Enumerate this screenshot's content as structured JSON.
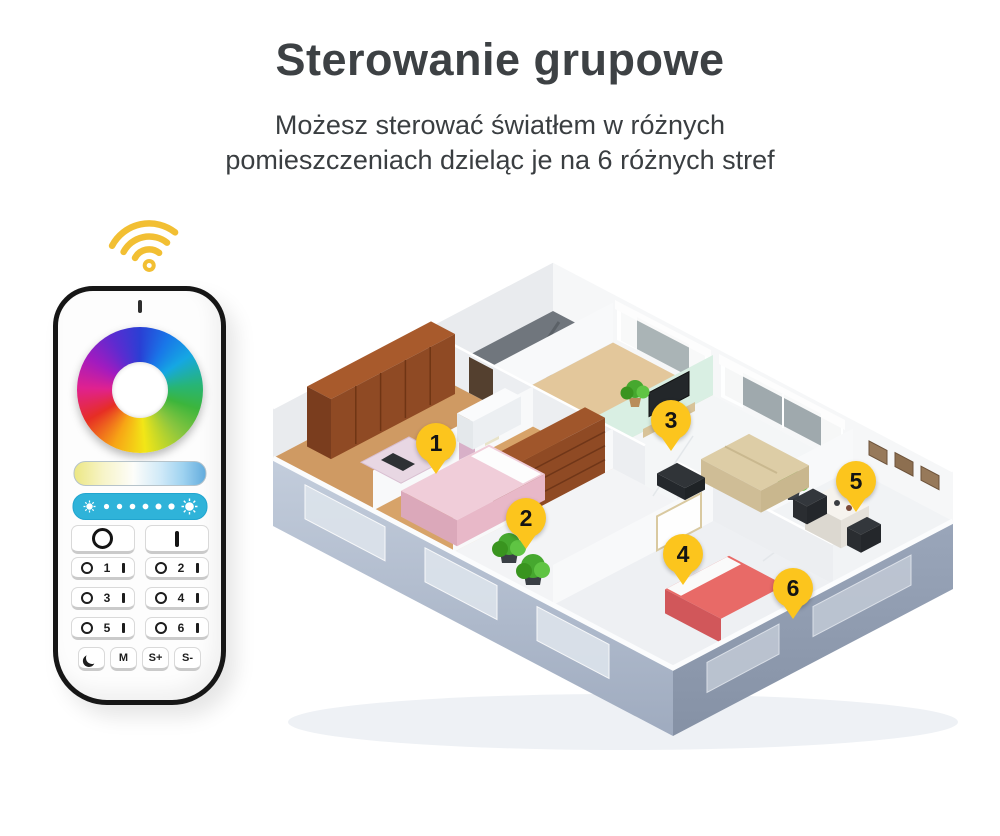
{
  "header": {
    "title": "Sterowanie grupowe",
    "subtitle_line1": "Możesz sterować światłem w różnych",
    "subtitle_line2": "pomieszczeniach dzieląc je na 6 różnych stref"
  },
  "remote": {
    "power_off_label": "O",
    "power_on_label": "I",
    "zone_buttons": [
      {
        "number": "1"
      },
      {
        "number": "2"
      },
      {
        "number": "3"
      },
      {
        "number": "4"
      },
      {
        "number": "5"
      },
      {
        "number": "6"
      }
    ],
    "bottom_buttons": [
      {
        "name": "night-mode",
        "icon": "crescent-moon-icon",
        "label": ""
      },
      {
        "name": "mode",
        "label": "M"
      },
      {
        "name": "speed-up",
        "label": "S+"
      },
      {
        "name": "speed-down",
        "label": "S-"
      }
    ],
    "colors": {
      "wifi_gold": "#f2bf33",
      "brightness_bar": "#2fb3d9",
      "body": "#fdfdfd",
      "outline": "#161616"
    }
  },
  "floor_plan": {
    "marker_color": "#fcc51d",
    "markers": [
      {
        "label": "1",
        "x": 173,
        "y": 187
      },
      {
        "label": "2",
        "x": 263,
        "y": 262
      },
      {
        "label": "3",
        "x": 408,
        "y": 164
      },
      {
        "label": "4",
        "x": 420,
        "y": 298
      },
      {
        "label": "5",
        "x": 593,
        "y": 225
      },
      {
        "label": "6",
        "x": 530,
        "y": 332
      }
    ]
  }
}
